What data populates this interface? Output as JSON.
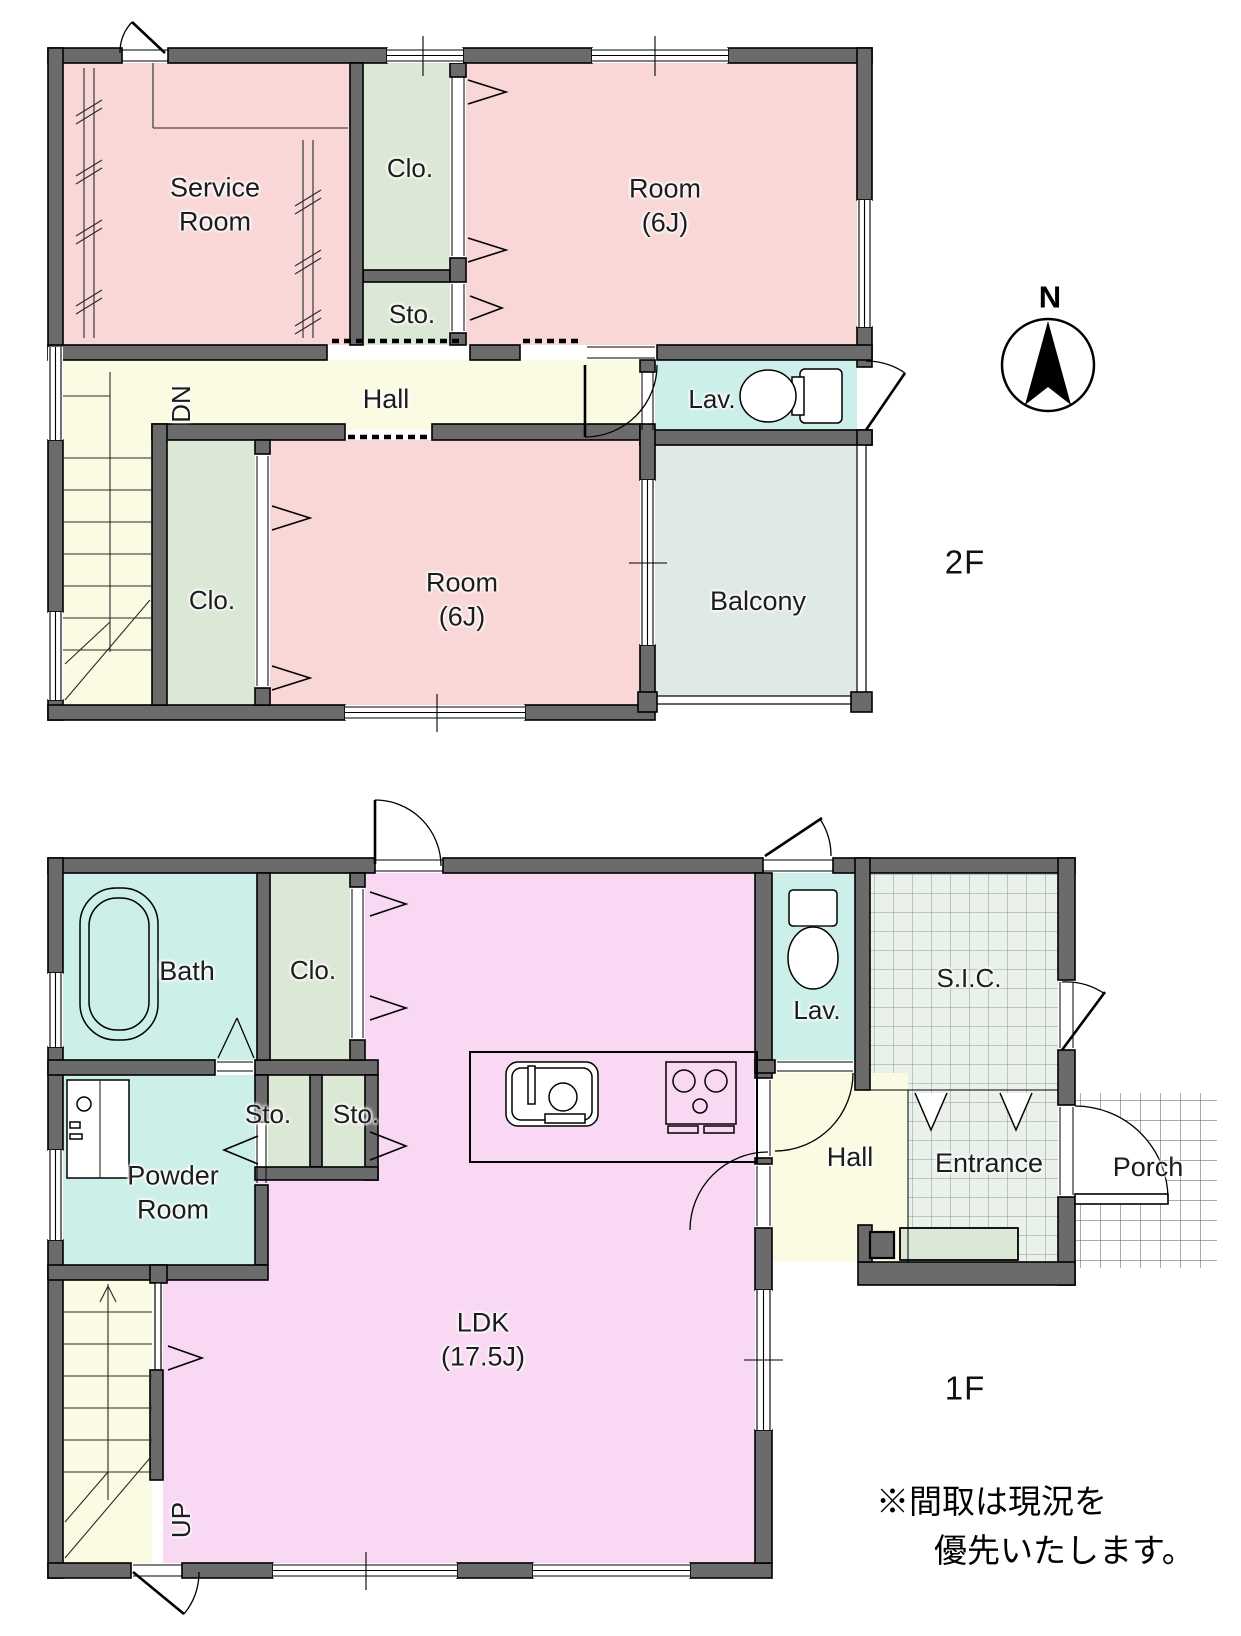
{
  "colors": {
    "wall": "#6b6b6b",
    "room_pink": "#f8d7d6",
    "closet_green": "#dce8d6",
    "hall_cream": "#fbfbe4",
    "wet_cyan": "#cdefe9",
    "balcony_gray": "#dfe9e6",
    "ldk_pink": "#f8d8f2",
    "tile_green": "#e9f1ea"
  },
  "floor2": {
    "floor_label": "2F",
    "compass_label": "N",
    "stairs_label": "DN",
    "rooms": {
      "service_room": {
        "line1": "Service",
        "line2": "Room"
      },
      "closet_top": {
        "label": "Clo."
      },
      "storage": {
        "label": "Sto."
      },
      "room_a": {
        "line1": "Room",
        "line2": "(6J)"
      },
      "hall": {
        "label": "Hall"
      },
      "lavatory": {
        "label": "Lav."
      },
      "closet_bottom": {
        "label": "Clo."
      },
      "room_b": {
        "line1": "Room",
        "line2": "(6J)"
      },
      "balcony": {
        "label": "Balcony"
      }
    }
  },
  "floor1": {
    "floor_label": "1F",
    "stairs_label": "UP",
    "rooms": {
      "bath": {
        "label": "Bath"
      },
      "closet": {
        "label": "Clo."
      },
      "storage_a": {
        "label": "Sto."
      },
      "storage_b": {
        "label": "Sto."
      },
      "powder_room": {
        "line1": "Powder",
        "line2": "Room"
      },
      "ldk": {
        "line1": "LDK",
        "line2": "(17.5J)"
      },
      "lavatory": {
        "label": "Lav."
      },
      "sic": {
        "label": "S.I.C."
      },
      "hall": {
        "label": "Hall"
      },
      "entrance": {
        "label": "Entrance"
      },
      "porch": {
        "label": "Porch"
      }
    }
  },
  "note": {
    "line1": "※間取は現況を",
    "line2": "優先いたします。"
  }
}
